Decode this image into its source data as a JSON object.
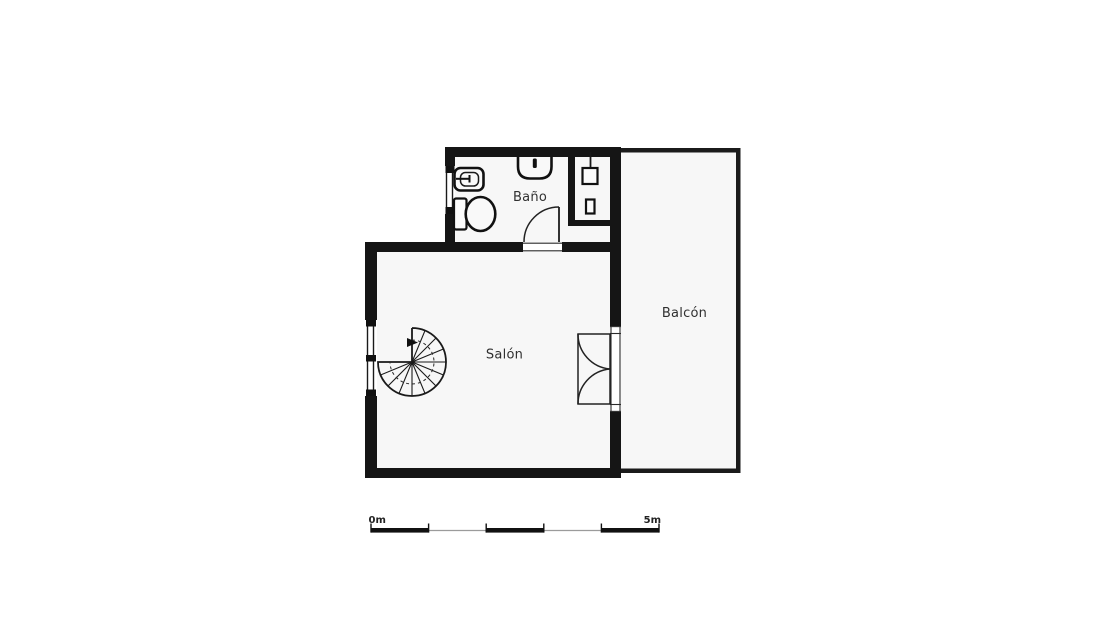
{
  "document": {
    "type": "architectural floor plan",
    "description": "Single-storey apartment plan with bathroom, living room with spiral staircase, and balcony"
  },
  "rooms": {
    "bathroom": {
      "label": "Baño"
    },
    "living_room": {
      "label": "Salón"
    },
    "balcony": {
      "label": "Balcón"
    }
  },
  "fixtures": {
    "bathroom": [
      "bidet",
      "toilet",
      "wall-washbasin",
      "water-heater-closet",
      "shower-drain"
    ],
    "living_room": [
      "spiral-staircase",
      "double-french-door",
      "window"
    ],
    "doors": [
      "bathroom-swing-door",
      "balcony-double-door"
    ],
    "windows": [
      "bathroom-window",
      "living-room-window"
    ]
  },
  "scale_bar": {
    "start_label": "0m",
    "end_label": "5m",
    "total_meters": 5,
    "segments": 5
  },
  "colors": {
    "background": "#ffffff",
    "wall": "#151515",
    "floor": "#f7f7f7",
    "line": "#1a1a1a",
    "label_text": "#303030",
    "scale_text": "#222222",
    "scale_gray": "#9b9b9b"
  }
}
